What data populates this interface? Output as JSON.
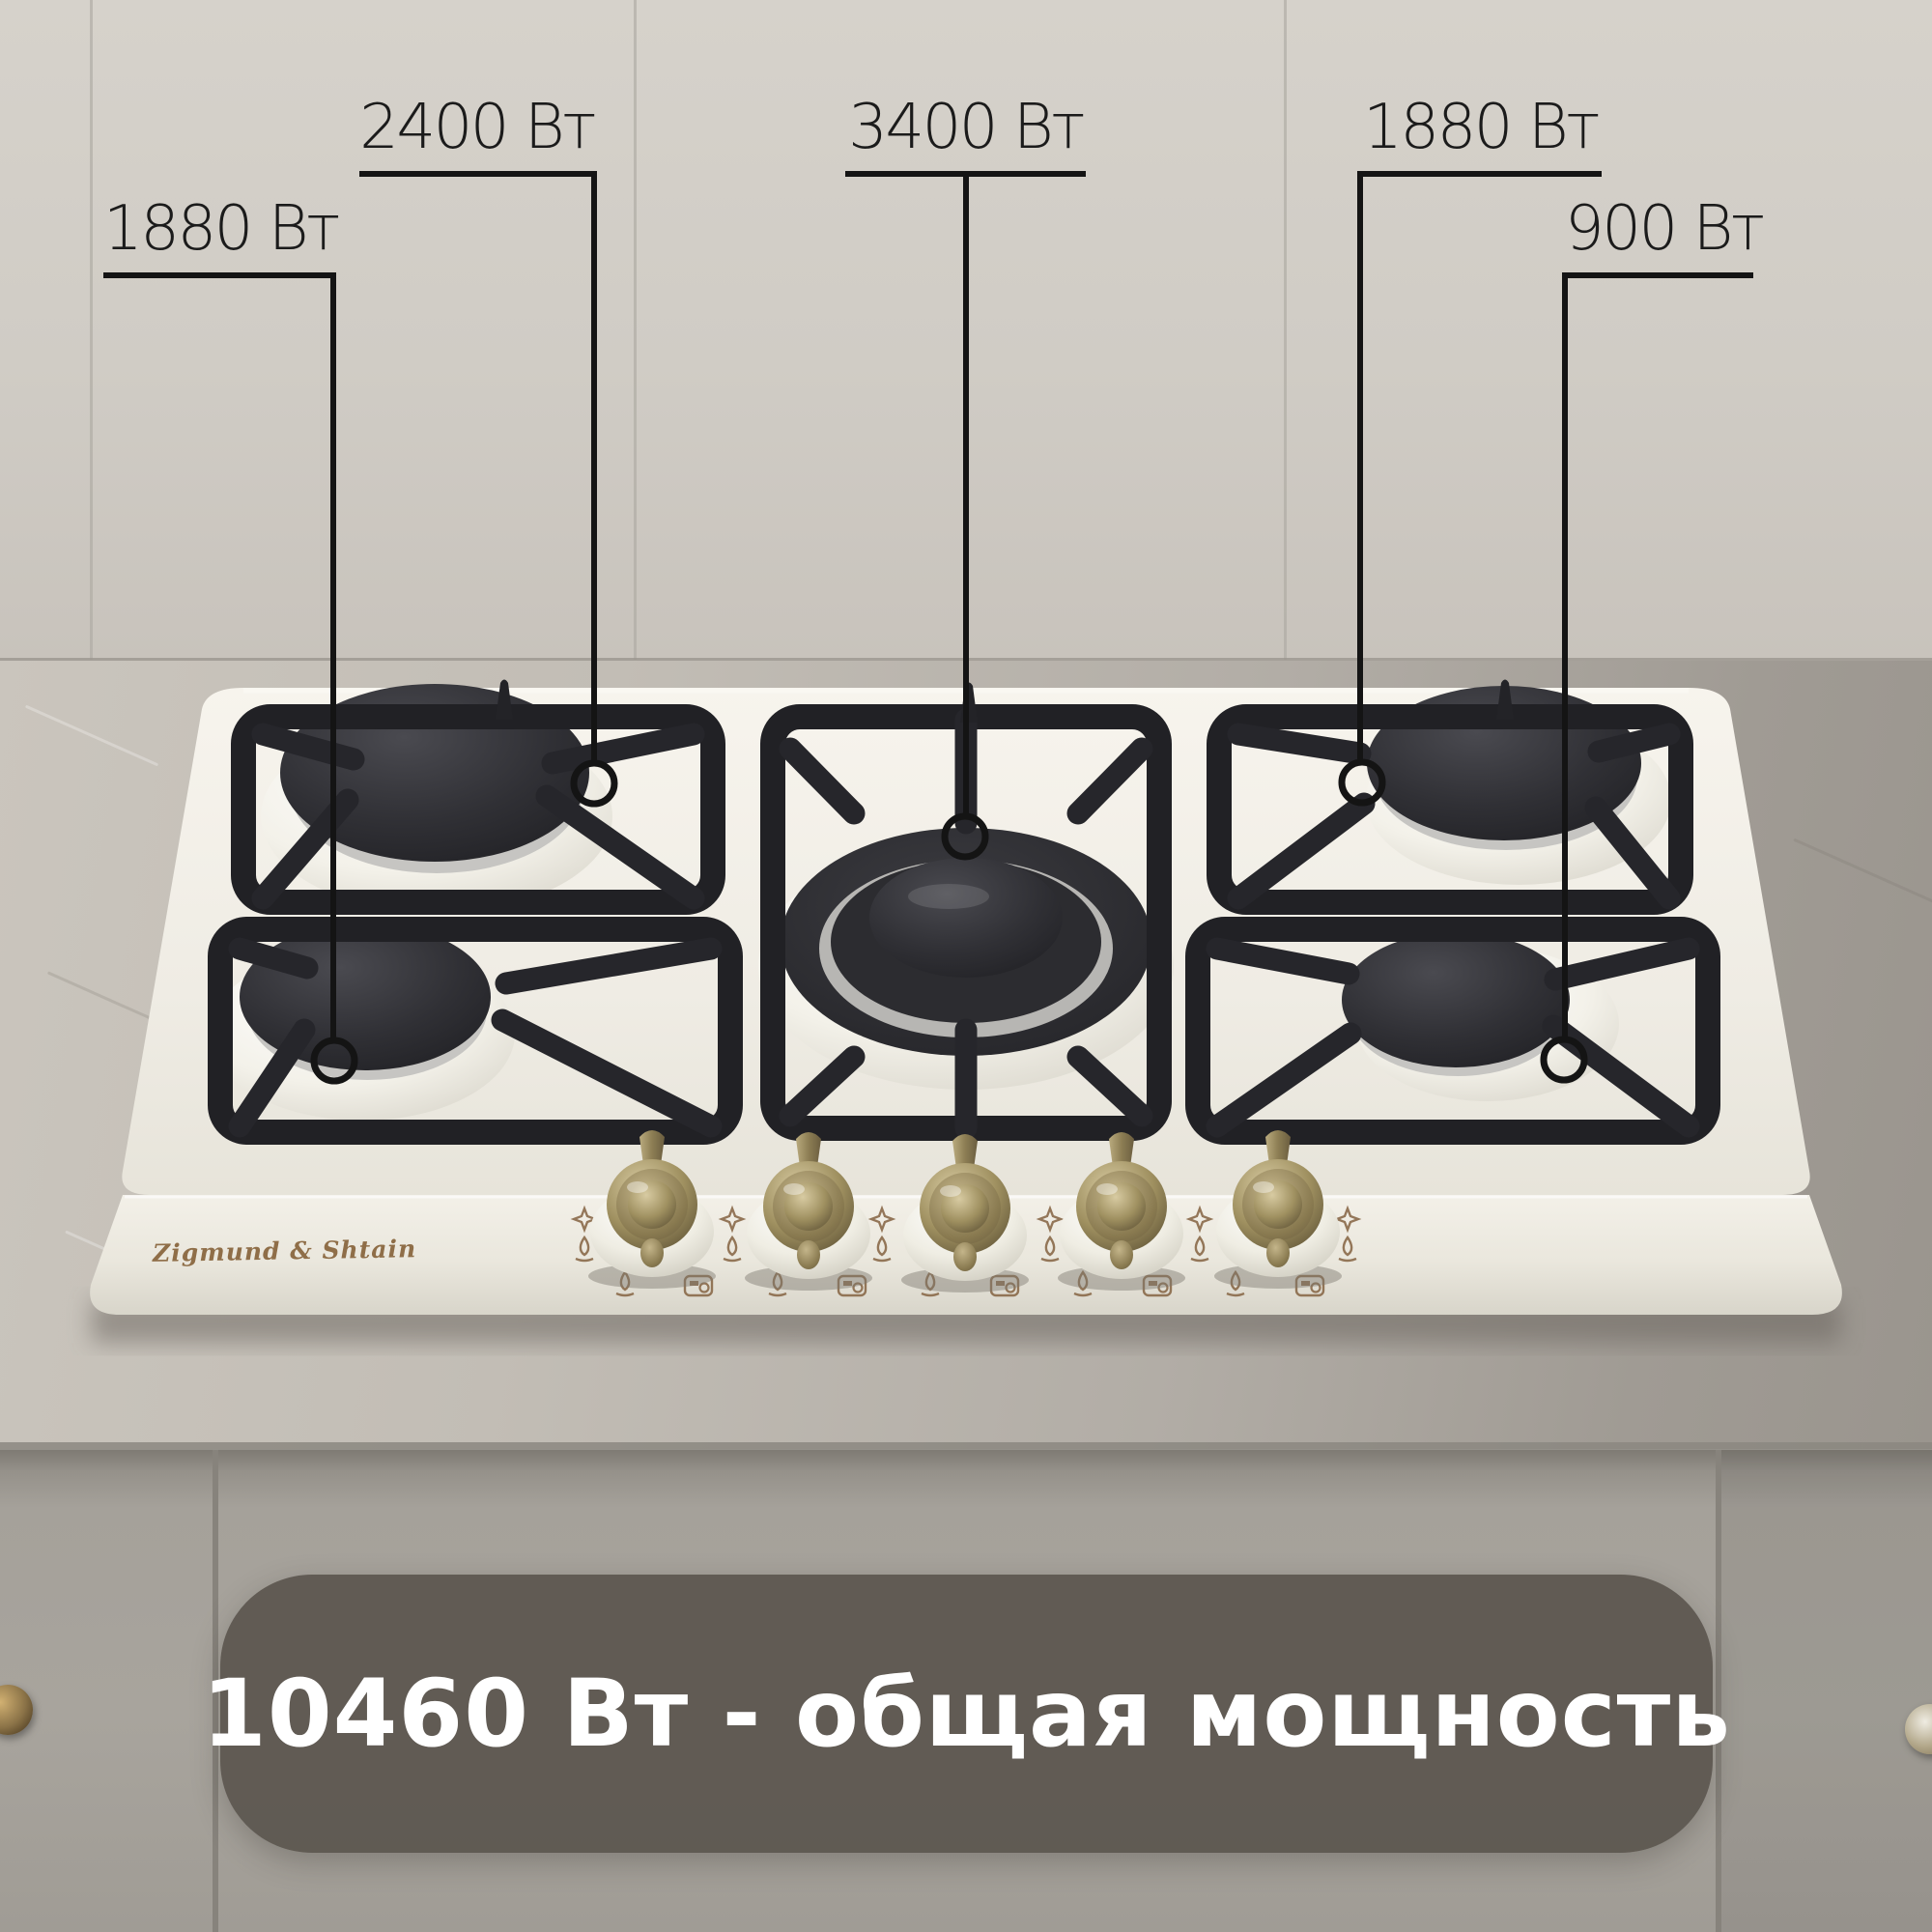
{
  "scene": {
    "description": "Product photo of a cream Zigmund & Shtain 5-burner gas hob built into a gray kitchen countertop, with burner power callouts"
  },
  "brand": {
    "logo": "Zigmund & Shtain"
  },
  "callouts": {
    "back_left": {
      "power": "2400 Вт"
    },
    "center": {
      "power": "3400 Вт"
    },
    "back_right": {
      "power": "1880 Вт"
    },
    "front_left": {
      "power": "1880 Вт"
    },
    "front_right": {
      "power": "900 Вт"
    }
  },
  "total": {
    "text": "10460 Вт - общая мощность"
  },
  "colors": {
    "annotation_line": "#141414",
    "banner_background": "#544d46",
    "banner_text": "#ffffff",
    "logo_text": "#8f6e48",
    "hob_body": "#f2efe7",
    "grate": "#232327",
    "wall": "#d0ccc5",
    "countertop": "#b2ada6",
    "cabinet": "#a5a19a"
  },
  "icons": {
    "panel_icon_1": "sparkle-icon",
    "panel_icon_2": "flame-icon",
    "panel_icon_3": "burner-zone-icon",
    "knob": "brass-control-knob",
    "cabinet_handle": "round-door-knob"
  }
}
